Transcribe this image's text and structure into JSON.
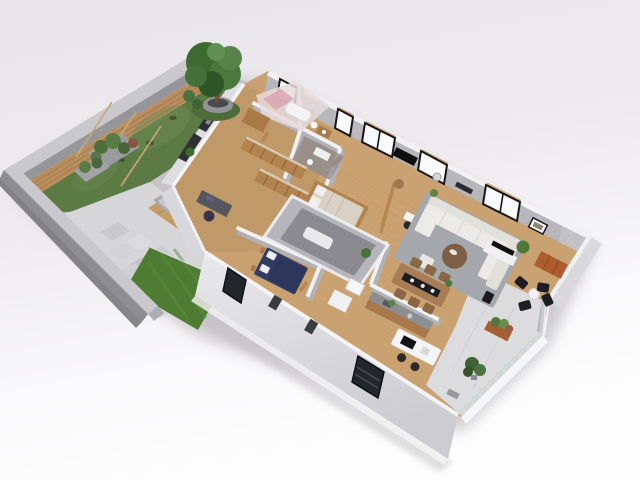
{
  "scene": {
    "type": "3d-floor-plan-render",
    "view": "isometric-top-down",
    "subject": "single-storey house with walled garden and terrace"
  },
  "colors": {
    "bg_top": "#e8e6e9",
    "bg_bottom": "#fdfdfd",
    "shadow": "#a39fa4",
    "perimeter_wall_top": "#c9c8cc",
    "perimeter_wall_face": "#96959a",
    "perimeter_wall_outer": "#8e8d91",
    "fence_wood": "#b98e5f",
    "grass": "#5b7a44",
    "lawn": "#4f7c33",
    "paving": "#d6d5d8",
    "deck_wood": "#c59d66",
    "lounge_sofa": "#abaaae",
    "lounge_table": "#2a2a2e",
    "tree_foliage": "#3c6a31",
    "tree_pot": "#949398",
    "floor_wood": "#caa171",
    "floor_wood_dark": "#b08a5c",
    "interior_wall": "#b2b1b6",
    "wall_cap": "#f2f2f5",
    "ne_wall_face": "#b7b6bb",
    "window_glass": "#f8fafc",
    "window_frame": "#17171a",
    "sw_wall_face": "#dcdbdf",
    "sw_wall_dark_window": "#23262a",
    "bath_pink": "#d9a9b4",
    "pod_wall": "#b6b5bb",
    "pod_inner": "#8b8a90",
    "bed_navy": "#323d63",
    "pillow_white": "#f0efef",
    "bed_beige": "#d9d2c4",
    "wardrobe_wood": "#b2834e",
    "door_wood": "#b5874f",
    "rug_gray": "#a4a8ad",
    "sofa_white": "#eceae6",
    "coffee_table": "#7d5f45",
    "dining_wood": "#a87c55",
    "runner_black": "#1d1d20",
    "counter_top": "#8d8e92",
    "island_white": "#f4f3f5",
    "cooktop_black": "#121214",
    "tv_black": "#0f0f12",
    "terrace_concrete": "#dcdbde",
    "chair_black": "#1d1e22",
    "cabinet_orange": "#ad5c2e",
    "planter_orange": "#a65f33",
    "plant_green": "#4d7a3b",
    "glass_rail": "#cdd7d2"
  },
  "garden": {
    "features": [
      "perimeter-wall",
      "wood-fence",
      "grass-area",
      "potted-tree",
      "support-stakes",
      "planter-boxes",
      "outdoor-lounge-deck",
      "gray-corner-sofa",
      "black-coffee-table",
      "stone-path",
      "bright-lawn",
      "shrubs"
    ]
  },
  "house": {
    "rooms": [
      "pink-bathroom",
      "walk-in-closet",
      "office",
      "gray-bathroom-pod",
      "bedroom-wood-bed",
      "bedroom-navy-bed",
      "small-bathroom",
      "hallway",
      "living-room",
      "dining-area",
      "kitchen",
      "terrace"
    ],
    "furniture": [
      "office-desk",
      "wardrobe-rows",
      "wood-frame-bed",
      "navy-bed",
      "bathtub",
      "slat-screen",
      "white-console-desk",
      "sectional-sofa",
      "round-coffee-table",
      "pouf",
      "tv-console",
      "dining-table",
      "dining-chairs",
      "kitchen-counter",
      "kitchen-island",
      "bar-stools",
      "orange-sideboard",
      "terrace-chairs",
      "terrace-table",
      "planters",
      "palm-plant",
      "wall-tv",
      "wall-frames"
    ],
    "counts": {
      "ne_wall_windows": 5,
      "terrace_chairs": 4,
      "dining_chairs": 6,
      "bar_stools": 2,
      "wall_frames": 2
    }
  }
}
